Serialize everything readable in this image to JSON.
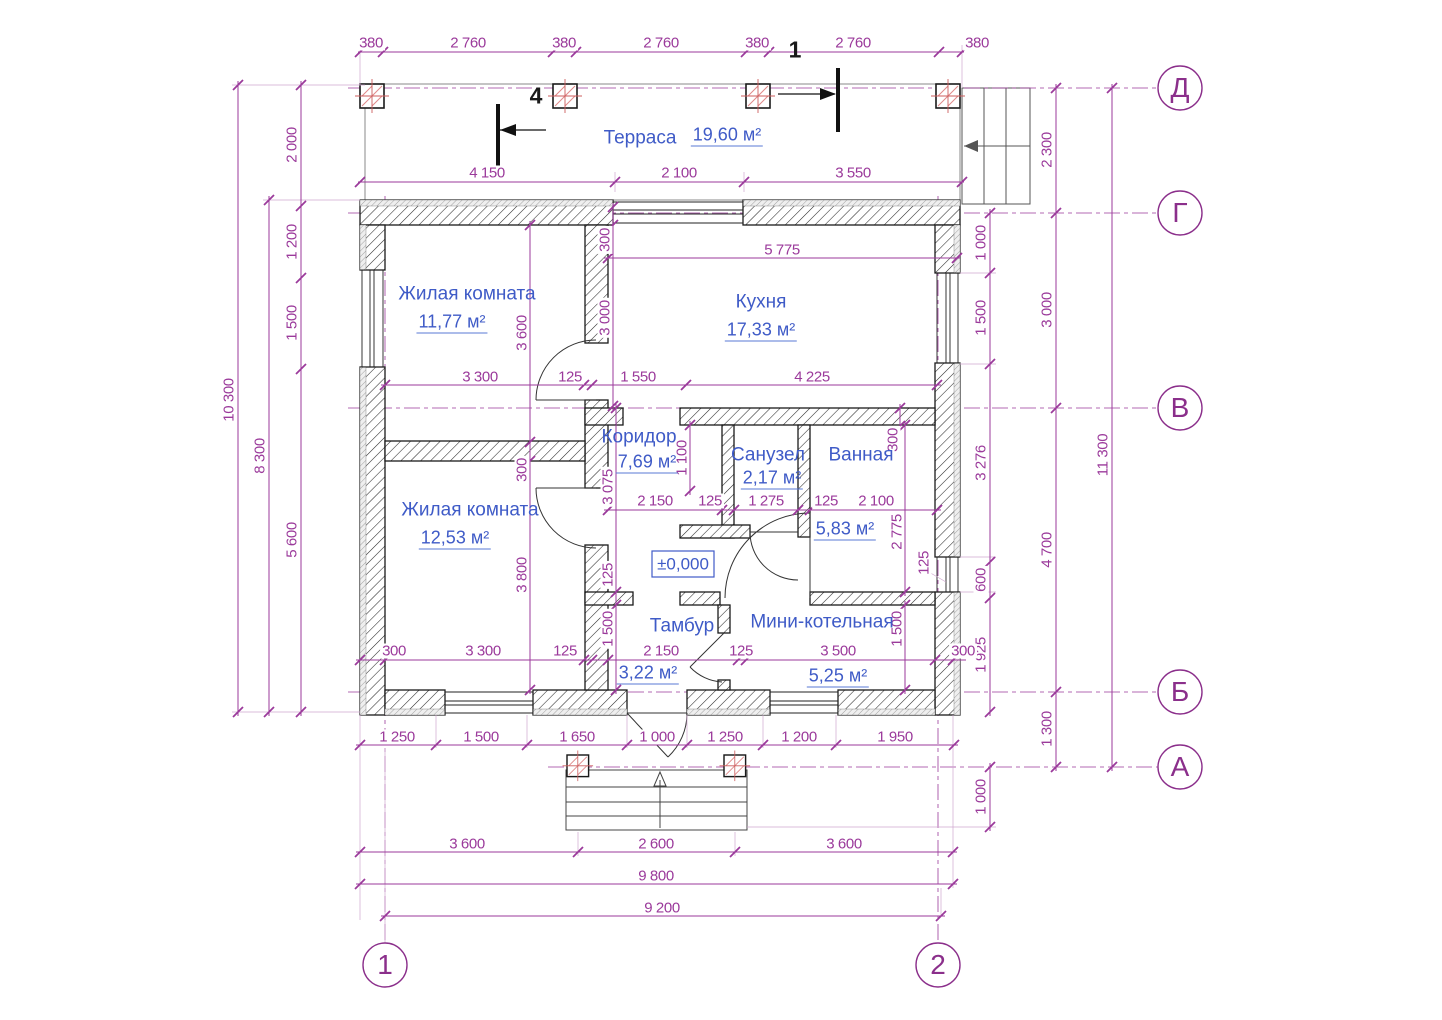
{
  "title": "План дома — строительный чертёж",
  "colors": {
    "dimension_text": "#9b3a9b",
    "axis_text": "#8b2f8b",
    "room_text": "#3f5bc7",
    "underline": "#5a79d6",
    "wall_line": "#1a1a1a",
    "column_accent": "#cc5c5c"
  },
  "rooms": [
    {
      "name": "Терраса",
      "area": "19,60 м²",
      "nx": 640,
      "ny": 138,
      "ax": 727,
      "ay": 136
    },
    {
      "name": "Жилая комната",
      "area": "11,77 м²",
      "nx": 467,
      "ny": 294,
      "ax": 452,
      "ay": 323
    },
    {
      "name": "Кухня",
      "area": "17,33 м²",
      "nx": 761,
      "ny": 302,
      "ax": 761,
      "ay": 331
    },
    {
      "name": "Коридор",
      "area": "7,69 м²",
      "nx": 639,
      "ny": 437,
      "ax": 647,
      "ay": 463
    },
    {
      "name": "Санузел",
      "area": "2,17 м²",
      "nx": 768,
      "ny": 455,
      "ax": 772,
      "ay": 479
    },
    {
      "name": "Ванная",
      "area": "5,83 м²",
      "nx": 861,
      "ny": 455,
      "ax": 845,
      "ay": 530
    },
    {
      "name": "Жилая комната",
      "area": "12,53 м²",
      "nx": 470,
      "ny": 510,
      "ax": 455,
      "ay": 539
    },
    {
      "name": "Тамбур",
      "area": "3,22 м²",
      "nx": 682,
      "ny": 626,
      "ax": 648,
      "ay": 674
    },
    {
      "name": "Мини-котельная",
      "area": "5,25 м²",
      "nx": 822,
      "ny": 622,
      "ax": 838,
      "ay": 677
    }
  ],
  "level_mark": {
    "t": "±0,000",
    "x": 683,
    "y": 564
  },
  "axis_markers": [
    {
      "t": "Д",
      "x": 1180,
      "y": 88
    },
    {
      "t": "Г",
      "x": 1180,
      "y": 213
    },
    {
      "t": "В",
      "x": 1180,
      "y": 408
    },
    {
      "t": "Б",
      "x": 1180,
      "y": 692
    },
    {
      "t": "А",
      "x": 1180,
      "y": 767
    },
    {
      "t": "1",
      "x": 385,
      "y": 965
    },
    {
      "t": "2",
      "x": 938,
      "y": 965
    }
  ],
  "section_marks": [
    {
      "t": "1",
      "x": 795,
      "y": 50
    },
    {
      "t": "4",
      "x": 536,
      "y": 96
    }
  ],
  "dimensions": [
    {
      "t": "380",
      "x": 371,
      "y": 43
    },
    {
      "t": "2 760",
      "x": 468,
      "y": 43
    },
    {
      "t": "380",
      "x": 564,
      "y": 43
    },
    {
      "t": "2 760",
      "x": 661,
      "y": 43
    },
    {
      "t": "380",
      "x": 757,
      "y": 43
    },
    {
      "t": "2 760",
      "x": 853,
      "y": 43
    },
    {
      "t": "380",
      "x": 977,
      "y": 43
    },
    {
      "t": "4 150",
      "x": 487,
      "y": 173
    },
    {
      "t": "2 100",
      "x": 679,
      "y": 173
    },
    {
      "t": "3 550",
      "x": 853,
      "y": 173
    },
    {
      "t": "10 300",
      "x": 229,
      "y": 400,
      "r": 1
    },
    {
      "t": "8 300",
      "x": 260,
      "y": 456,
      "r": 1
    },
    {
      "t": "2 000",
      "x": 292,
      "y": 145,
      "r": 1
    },
    {
      "t": "1 200",
      "x": 292,
      "y": 242,
      "r": 1
    },
    {
      "t": "1 500",
      "x": 292,
      "y": 323,
      "r": 1
    },
    {
      "t": "5 600",
      "x": 292,
      "y": 540,
      "r": 1
    },
    {
      "t": "1 000",
      "x": 981,
      "y": 243,
      "r": 1
    },
    {
      "t": "1 500",
      "x": 981,
      "y": 318,
      "r": 1
    },
    {
      "t": "3 276",
      "x": 981,
      "y": 463,
      "r": 1
    },
    {
      "t": "600",
      "x": 981,
      "y": 580,
      "r": 1
    },
    {
      "t": "1 925",
      "x": 981,
      "y": 655,
      "r": 1
    },
    {
      "t": "1 000",
      "x": 981,
      "y": 797,
      "r": 1
    },
    {
      "t": "2 300",
      "x": 1047,
      "y": 150,
      "r": 1
    },
    {
      "t": "3 000",
      "x": 1047,
      "y": 310,
      "r": 1
    },
    {
      "t": "4 700",
      "x": 1047,
      "y": 550,
      "r": 1
    },
    {
      "t": "1 300",
      "x": 1047,
      "y": 729,
      "r": 1
    },
    {
      "t": "11 300",
      "x": 1103,
      "y": 455,
      "r": 1
    },
    {
      "t": "1 250",
      "x": 397,
      "y": 737
    },
    {
      "t": "1 500",
      "x": 481,
      "y": 737
    },
    {
      "t": "1 650",
      "x": 577,
      "y": 737
    },
    {
      "t": "1 000",
      "x": 657,
      "y": 737
    },
    {
      "t": "1 250",
      "x": 725,
      "y": 737
    },
    {
      "t": "1 200",
      "x": 799,
      "y": 737
    },
    {
      "t": "1 950",
      "x": 895,
      "y": 737
    },
    {
      "t": "3 600",
      "x": 467,
      "y": 844
    },
    {
      "t": "2 600",
      "x": 656,
      "y": 844
    },
    {
      "t": "3 600",
      "x": 844,
      "y": 844
    },
    {
      "t": "9 800",
      "x": 656,
      "y": 876
    },
    {
      "t": "9 200",
      "x": 662,
      "y": 908
    },
    {
      "t": "300",
      "x": 605,
      "y": 240,
      "r": 1
    },
    {
      "t": "3 000",
      "x": 605,
      "y": 318,
      "r": 1
    },
    {
      "t": "5 775",
      "x": 782,
      "y": 250
    },
    {
      "t": "3 600",
      "x": 522,
      "y": 333,
      "r": 1
    },
    {
      "t": "300",
      "x": 522,
      "y": 470,
      "r": 1
    },
    {
      "t": "3 800",
      "x": 522,
      "y": 575,
      "r": 1
    },
    {
      "t": "3 300",
      "x": 480,
      "y": 377
    },
    {
      "t": "125",
      "x": 570,
      "y": 377
    },
    {
      "t": "1 550",
      "x": 638,
      "y": 377
    },
    {
      "t": "4 225",
      "x": 812,
      "y": 377
    },
    {
      "t": "3 075",
      "x": 608,
      "y": 487,
      "r": 1
    },
    {
      "t": "125",
      "x": 608,
      "y": 575,
      "r": 1
    },
    {
      "t": "1 500",
      "x": 608,
      "y": 629,
      "r": 1
    },
    {
      "t": "1 100",
      "x": 682,
      "y": 458,
      "r": 1
    },
    {
      "t": "2 150",
      "x": 655,
      "y": 501
    },
    {
      "t": "125",
      "x": 710,
      "y": 501
    },
    {
      "t": "1 275",
      "x": 766,
      "y": 501
    },
    {
      "t": "125",
      "x": 826,
      "y": 501
    },
    {
      "t": "2 100",
      "x": 876,
      "y": 501
    },
    {
      "t": "300",
      "x": 893,
      "y": 440,
      "r": 1
    },
    {
      "t": "2 775",
      "x": 897,
      "y": 532,
      "r": 1
    },
    {
      "t": "125",
      "x": 924,
      "y": 563,
      "r": 1
    },
    {
      "t": "1 500",
      "x": 897,
      "y": 629,
      "r": 1
    },
    {
      "t": "300",
      "x": 394,
      "y": 651
    },
    {
      "t": "3 300",
      "x": 483,
      "y": 651
    },
    {
      "t": "125",
      "x": 565,
      "y": 651
    },
    {
      "t": "2 150",
      "x": 661,
      "y": 651
    },
    {
      "t": "125",
      "x": 741,
      "y": 651
    },
    {
      "t": "3 500",
      "x": 838,
      "y": 651
    },
    {
      "t": "300",
      "x": 963,
      "y": 651
    }
  ]
}
